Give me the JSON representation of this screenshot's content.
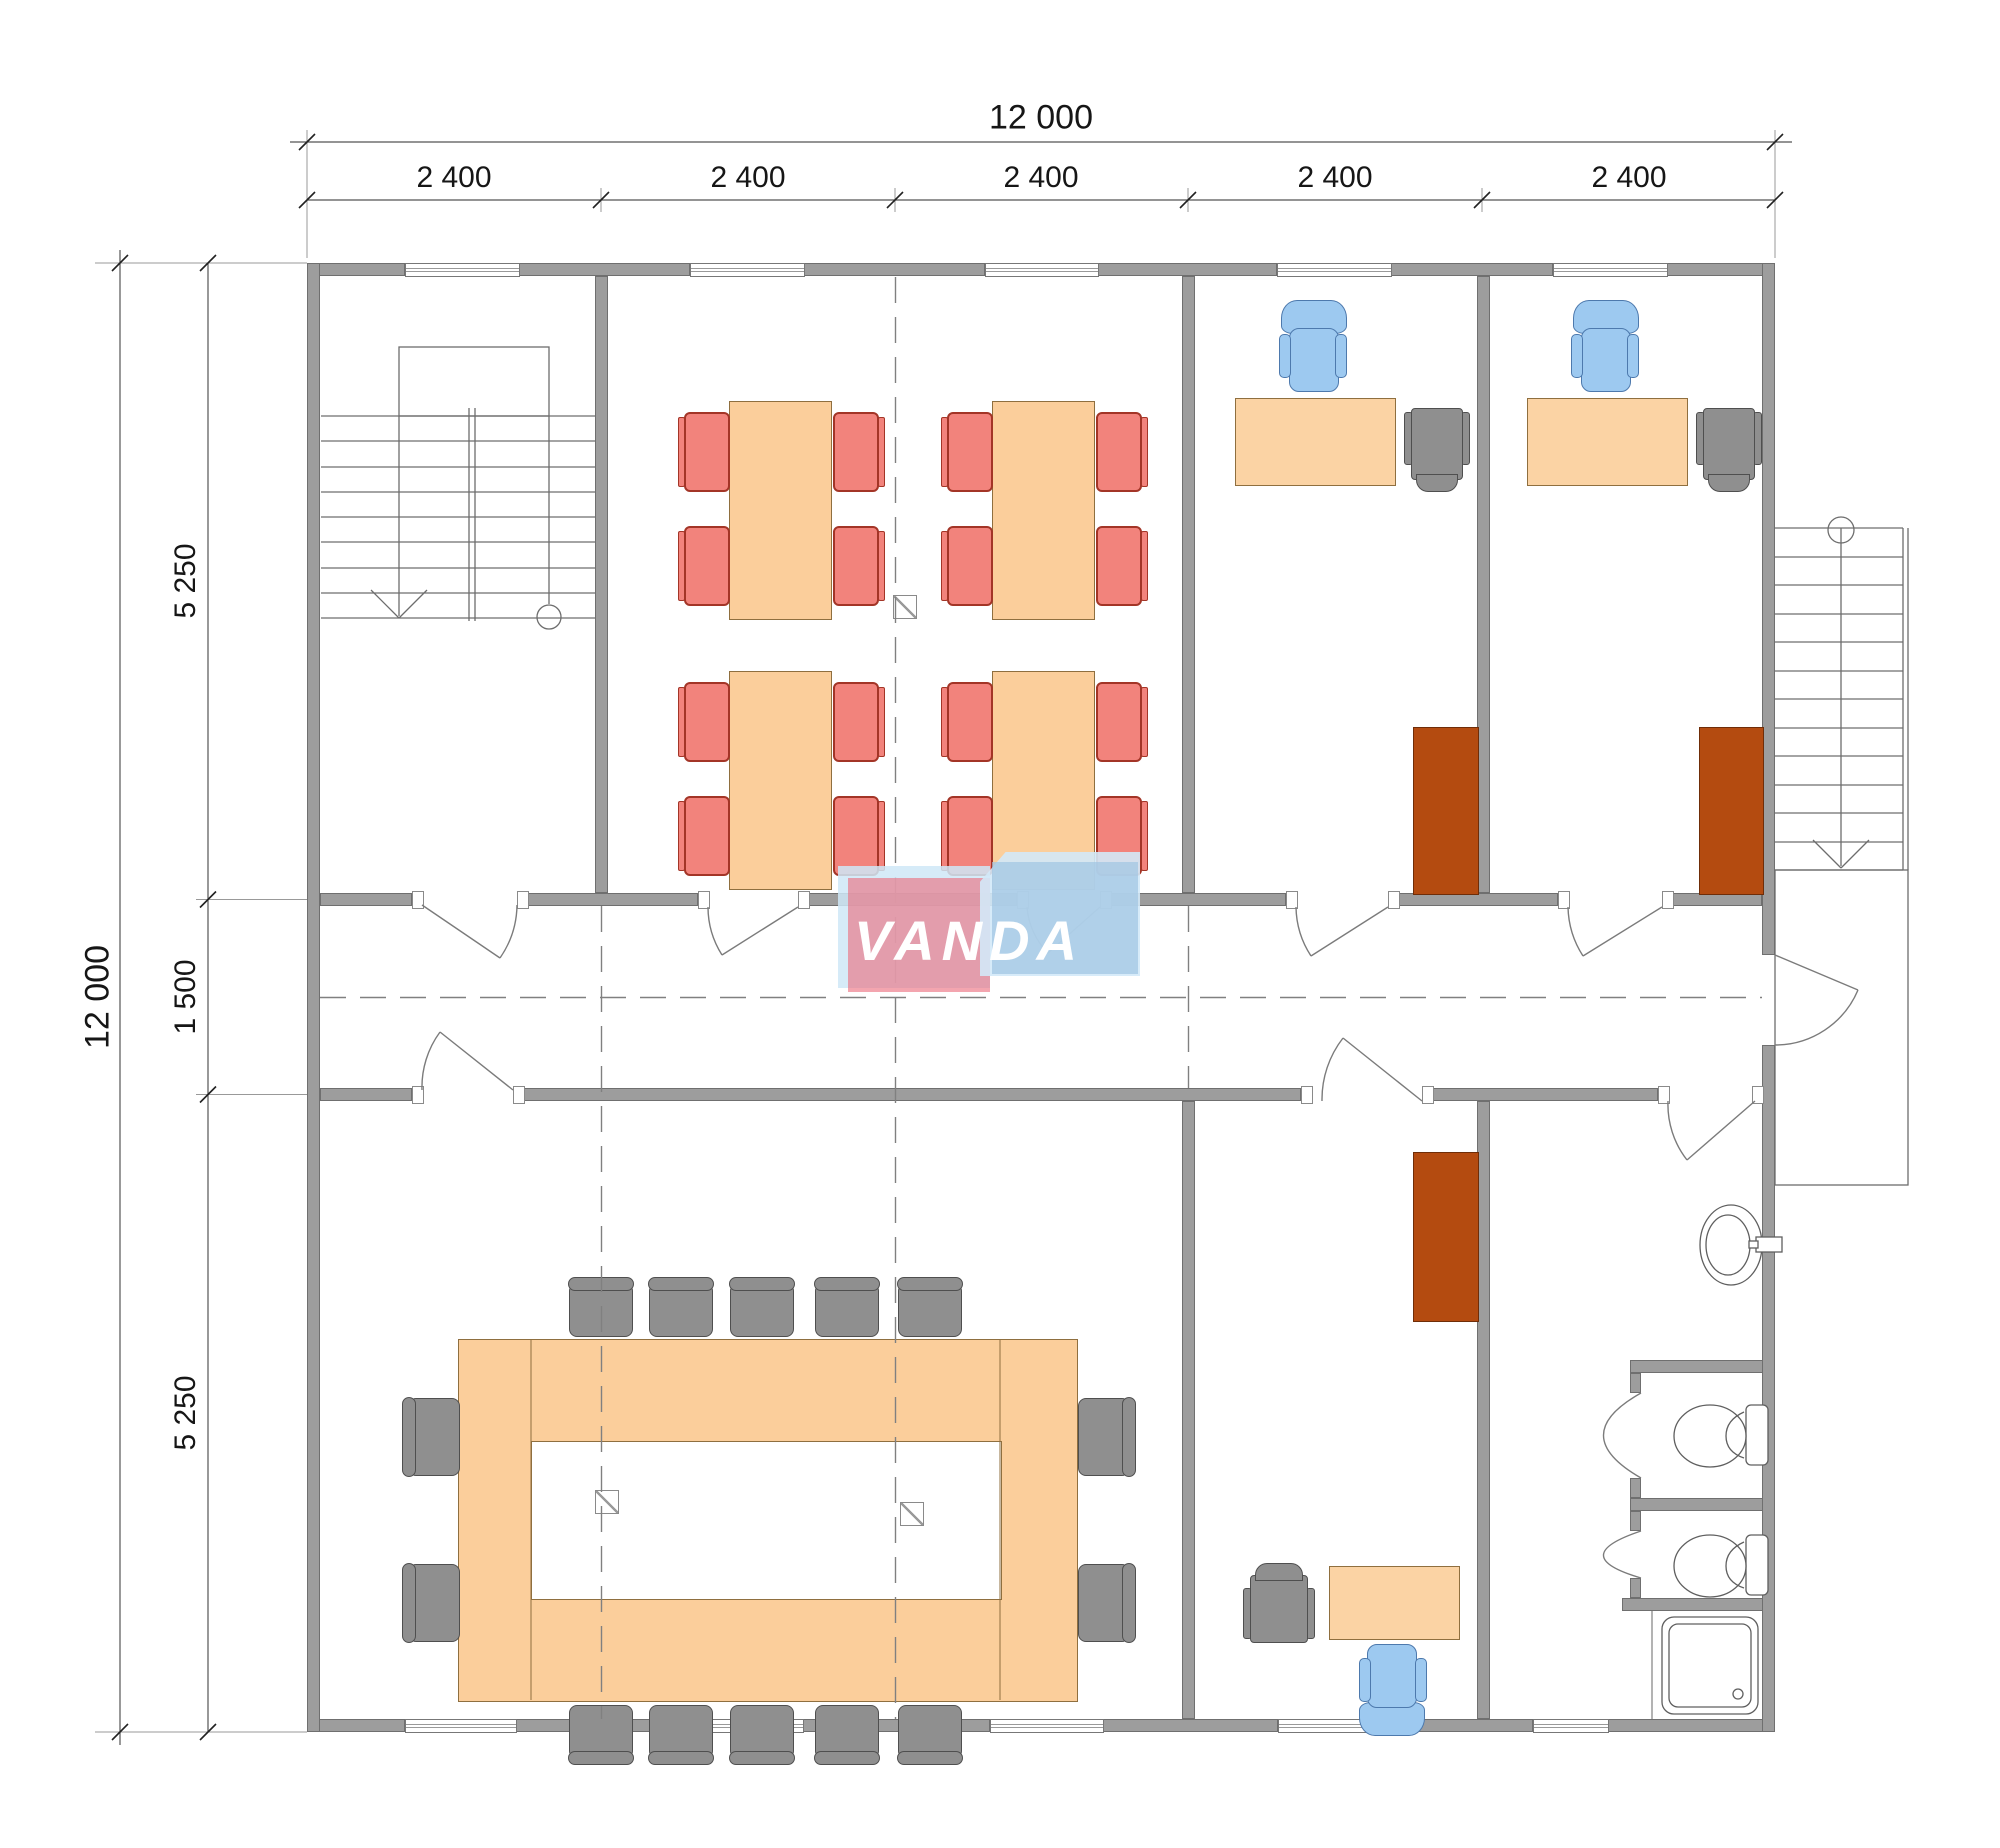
{
  "title": "office-floor-plan",
  "dimensions": {
    "overall_width_label": "12 000",
    "overall_height_label": "12 000",
    "top_segment_labels": [
      "2 400",
      "2 400",
      "2 400",
      "2 400",
      "2 400"
    ],
    "left_segment_labels": [
      "5 250",
      "1 500",
      "5 250"
    ]
  },
  "logo": {
    "text": "VANDA"
  },
  "colors": {
    "wall_fill": "#9d9d9d",
    "wall_edge": "#6f6f6f",
    "wood_furniture": "#fbce9b",
    "chair_red": "#f2837c",
    "chair_red_edge": "#a33527",
    "chair_blue": "#9dc9f0",
    "furniture_gray": "#8f8f8f",
    "cabinet_brown": "#b44b10",
    "logo_pink": "#ec6e7e",
    "logo_blue": "#9fc4e2",
    "logo_pale_blue": "#cfe8f7"
  }
}
